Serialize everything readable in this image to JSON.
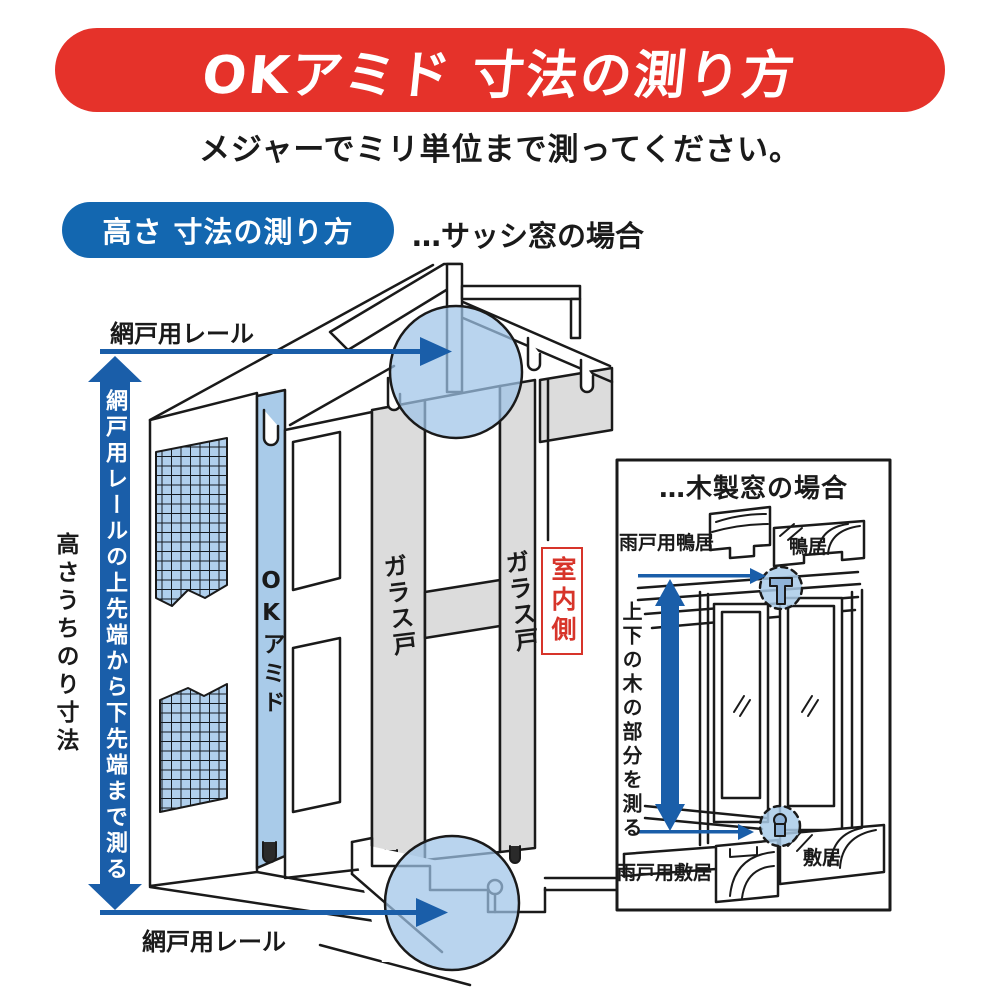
{
  "banner": {
    "title": "OKアミド 寸法の測り方"
  },
  "subtitle": "メジャーでミリ単位まで測ってください。",
  "height_section": {
    "badge": "高さ 寸法の測り方",
    "case_note": "…サッシ窓の場合"
  },
  "sash_diagram": {
    "rail_top": "網戸用レール",
    "rail_bottom": "網戸用レール",
    "measure_note": "網戸用レールの上先端から下先端まで測る",
    "opening_height": "高さうちのり寸法",
    "screen_name": "OKアミド",
    "glass_door_front": "ガラス戸",
    "glass_door_back": "ガラス戸",
    "indoor_side": "室内側"
  },
  "wood_window_panel": {
    "title": "…木製窓の場合",
    "shutter_lintel": "雨戸用鴨居",
    "lintel": "鴨居",
    "measure_note": "上下の木の部分を測る",
    "shutter_sill": "雨戸用敷居",
    "sill": "敷居"
  },
  "colors": {
    "banner_red": "#e5322a",
    "badge_blue": "#1367b0",
    "arrow_blue": "#1a5ea9",
    "highlight_blue": "#a9cbe9",
    "door_gray": "#dcdcdc",
    "indoor_red": "#d7342a"
  }
}
